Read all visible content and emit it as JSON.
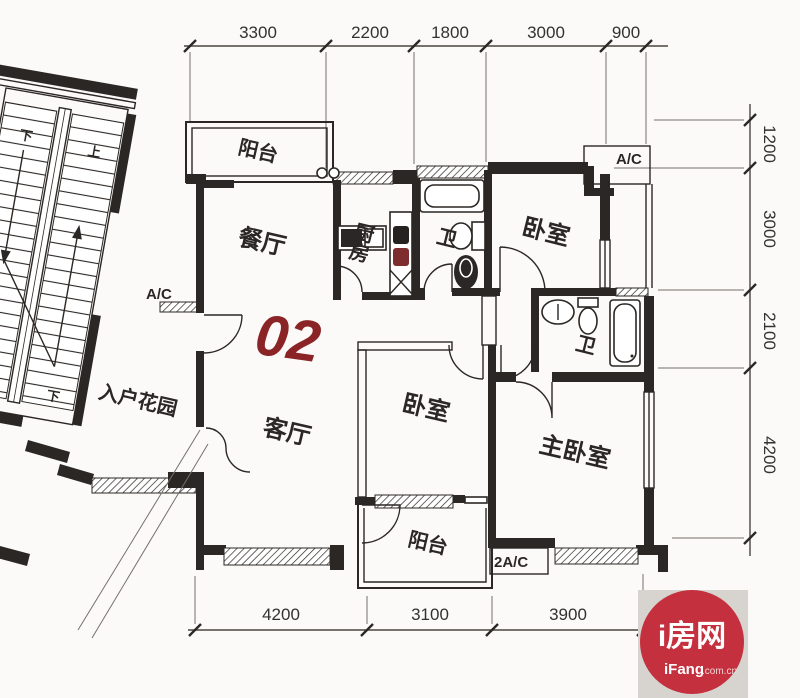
{
  "plan": {
    "unit_number": "02",
    "rooms": {
      "balcony_top": "阳台",
      "dining": "餐厅",
      "kitchen": "厨房",
      "bath_top": "卫",
      "bedroom_top": "卧室",
      "bath_right": "卫",
      "bedroom_mid": "卧室",
      "master_bedroom": "主卧室",
      "living": "客厅",
      "entry_garden": "入户花园",
      "balcony_bottom": "阳台"
    },
    "annotations": {
      "ac_left": "A/C",
      "ac_top_right": "A/C",
      "ac_bottom": "2A/C",
      "stair_down": "下",
      "stair_up": "上"
    },
    "dimensions": {
      "top": [
        "3300",
        "2200",
        "1800",
        "3000",
        "900"
      ],
      "right": [
        "1200",
        "3000",
        "2100",
        "4200"
      ],
      "bottom": [
        "4200",
        "3100",
        "3900"
      ]
    },
    "colors": {
      "unit_number": "#8b2427",
      "line": "#2b2724",
      "logo_red": "#c4303e",
      "logo_bg": "#d7d4cf"
    }
  },
  "logo": {
    "name": "i房网",
    "domain_bold": "iFang",
    "domain_suffix": ".com.cn"
  }
}
